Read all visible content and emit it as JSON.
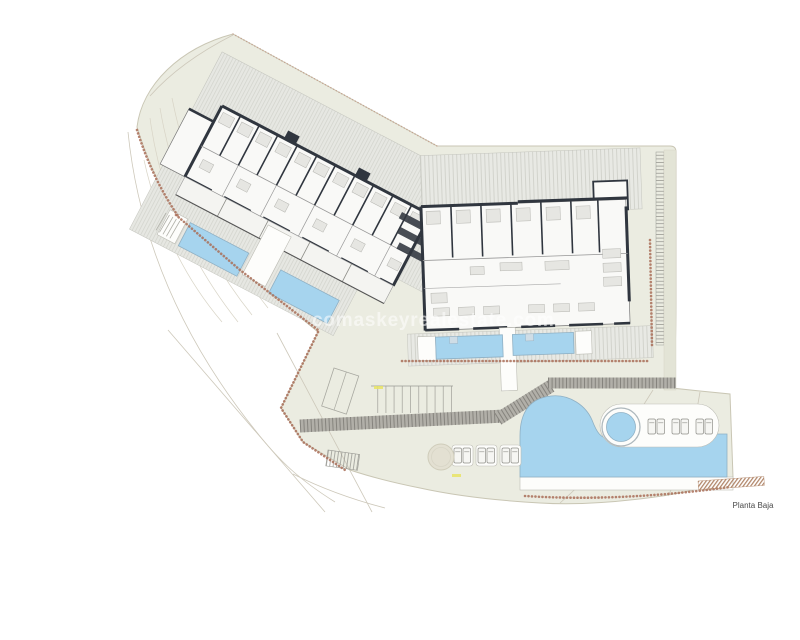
{
  "plan": {
    "floor_label": "Planta Baja",
    "watermark": "comaskeyrealestate.com"
  },
  "colors": {
    "background": "#ffffff",
    "site_fill": "#ebece1",
    "site_edge": "#c9c6b4",
    "pool_water": "#a6d4ee",
    "pool_edge": "#8fb0c4",
    "wall_dark": "#30363f",
    "deck_base": "#e8e9e4",
    "deck_stripe": "#c9cac2",
    "road_gray": "#b1afa8",
    "road_hatch": "#86847e",
    "terrain_chain": "#a96f58",
    "label_text": "#4a4a4a",
    "watermark_color": "#ffffff",
    "accent_yellow": "#e9e464"
  }
}
